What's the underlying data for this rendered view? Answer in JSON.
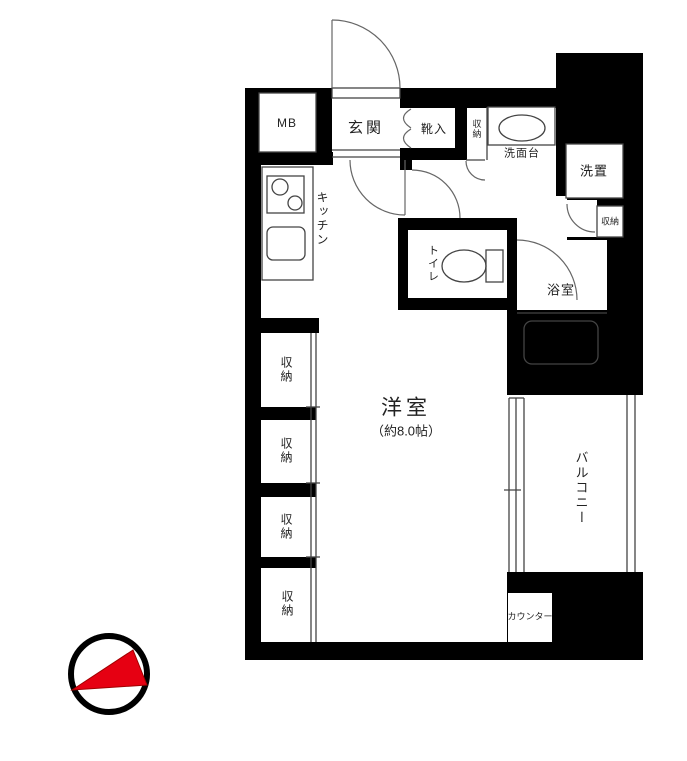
{
  "rooms": {
    "mb": "MB",
    "entrance": "玄関",
    "shoe_box": "靴入",
    "hall_storage": "収納",
    "washbasin": "洗面台",
    "washer": "洗置",
    "washroom_storage": "収納",
    "kitchen": "キッチン",
    "toilet": "トイレ",
    "bathroom": "浴室",
    "living": "洋室",
    "living_size": "（約8.0帖）",
    "closet_1": "収納",
    "closet_2": "収納",
    "closet_3": "収納",
    "closet_4": "収納",
    "balcony": "バルコニー",
    "counter": "カウンター"
  },
  "colors": {
    "wall": "#000000",
    "floor": "#ffffff",
    "compass_red": "#e60012"
  }
}
